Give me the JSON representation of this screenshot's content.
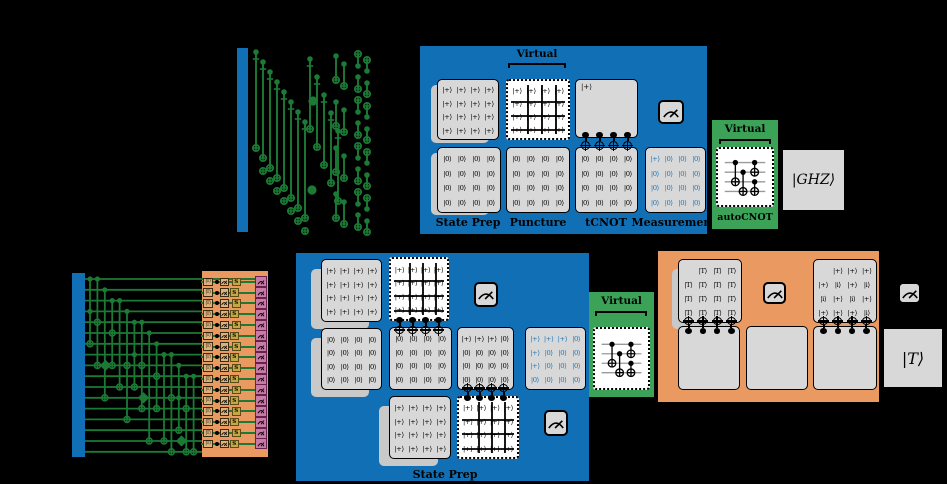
{
  "colors": {
    "factory_blue": "#1170b5",
    "virtual_green": "#3ba257",
    "distill_orange": "#ea9a60",
    "circuit_green": "#1b7a35",
    "card_gray": "#d8d8d8",
    "ket_blue": "#2176b5",
    "meter_pink": "#c77ba6",
    "s_olive": "#c2a945"
  },
  "grids": {
    "plus4": [
      [
        "|+⟩",
        "|+⟩",
        "|+⟩",
        "|+⟩"
      ],
      [
        "|+⟩",
        "|+⟩",
        "|+⟩",
        "|+⟩"
      ],
      [
        "|+⟩",
        "|+⟩",
        "|+⟩",
        "|+⟩"
      ],
      [
        "|+⟩",
        "|+⟩",
        "|+⟩",
        "|+⟩"
      ]
    ],
    "zero4": [
      [
        "|0⟩",
        "|0⟩",
        "|0⟩",
        "|0⟩"
      ],
      [
        "|0⟩",
        "|0⟩",
        "|0⟩",
        "|0⟩"
      ],
      [
        "|0⟩",
        "|0⟩",
        "|0⟩",
        "|0⟩"
      ],
      [
        "|0⟩",
        "|0⟩",
        "|0⟩",
        "|0⟩"
      ]
    ],
    "meas_a": [
      [
        "|+⟩",
        "|0⟩",
        "|0⟩",
        "|0⟩"
      ],
      [
        "|0⟩",
        "|0⟩",
        "|0⟩",
        "|0⟩"
      ],
      [
        "|0⟩",
        "|0⟩",
        "|0⟩",
        "|0⟩"
      ],
      [
        "|0⟩",
        "|0⟩",
        "|0⟩",
        "|0⟩"
      ]
    ],
    "mixed_b": [
      [
        "|+⟩",
        "|+⟩",
        "|+⟩",
        "|0⟩"
      ],
      [
        "|0⟩",
        "|0⟩",
        "|0⟩",
        "|0⟩"
      ],
      [
        "|0⟩",
        "|0⟩",
        "|0⟩",
        "|0⟩"
      ],
      [
        "|0⟩",
        "|0⟩",
        "|0⟩",
        "|0⟩"
      ]
    ],
    "blue_b": [
      [
        "|+⟩",
        "|+⟩",
        "|+⟩",
        "|0⟩"
      ],
      [
        "|+⟩",
        "|0⟩",
        "|0⟩",
        "|0⟩"
      ],
      [
        "|+⟩",
        "|0⟩",
        "|0⟩",
        "|0⟩"
      ],
      [
        "|0⟩",
        "|0⟩",
        "|0⟩",
        "|0⟩"
      ]
    ],
    "t_grid": [
      [
        "",
        "|T⟩",
        "|T⟩",
        "|T⟩"
      ],
      [
        "|T⟩",
        "|T⟩",
        "|T⟩",
        "|T⟩"
      ],
      [
        "|T⟩",
        "|T⟩",
        "|T⟩",
        "|T⟩"
      ],
      [
        "|T⟩",
        "|T⟩",
        "|T⟩",
        "|T⟩"
      ]
    ],
    "i_grid": [
      [
        "",
        "|+⟩",
        "|+⟩",
        "|+⟩"
      ],
      [
        "|+⟩",
        "|i⟩",
        "|+⟩",
        "|i⟩"
      ],
      [
        "|i⟩",
        "|+⟩",
        "|i⟩",
        "|+⟩"
      ],
      [
        "|+⟩",
        "|+⟩",
        "|+⟩",
        "|i⟩"
      ]
    ]
  },
  "row_a": {
    "virtual": "Virtual",
    "tcnot_top_ket": "|+⟩",
    "stages": [
      "State Prep",
      "Puncture",
      "tCNOT",
      "Measurement"
    ],
    "autocnot_virtual": "Virtual",
    "autocnot_label": "autoCNOT",
    "output": "|GHZ⟩"
  },
  "row_b": {
    "stage_label": "State Prep",
    "virtual": "Virtual",
    "t_ket": "|T⟩",
    "s_label": "S",
    "output": "|T⟩"
  }
}
